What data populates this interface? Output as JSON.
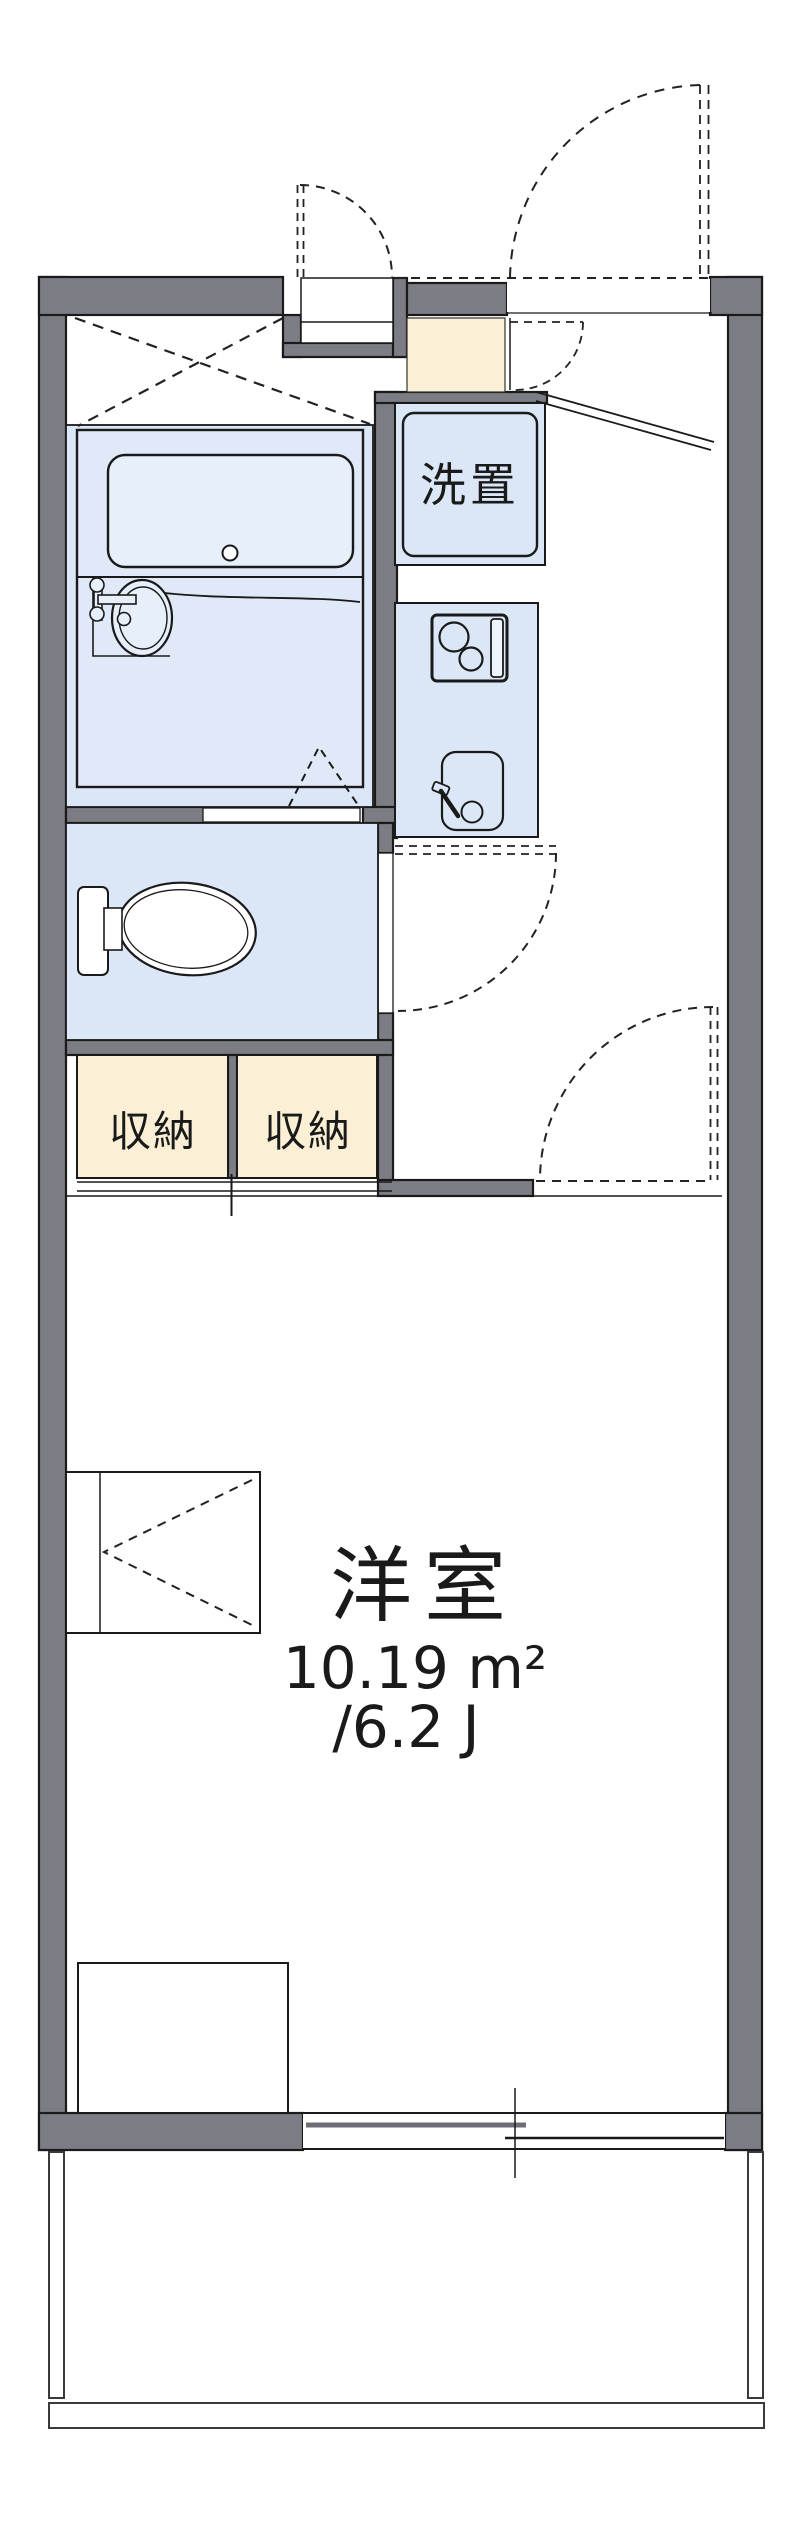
{
  "plan": {
    "type": "floorplan",
    "labels": {
      "washer_space": "洗置",
      "storage_left": "収納",
      "storage_right": "収納",
      "room_name": "洋室",
      "room_area_sqm": "10.19 m²",
      "room_area_tatami": "/6.2 J"
    },
    "colors": {
      "wall_gray": "#7c7c84",
      "water_blue": "#dbe7f7",
      "fixture_blue_light": "#e7effb",
      "storage_beige": "#fbefd5",
      "line_dark": "#1a1a1a"
    }
  }
}
